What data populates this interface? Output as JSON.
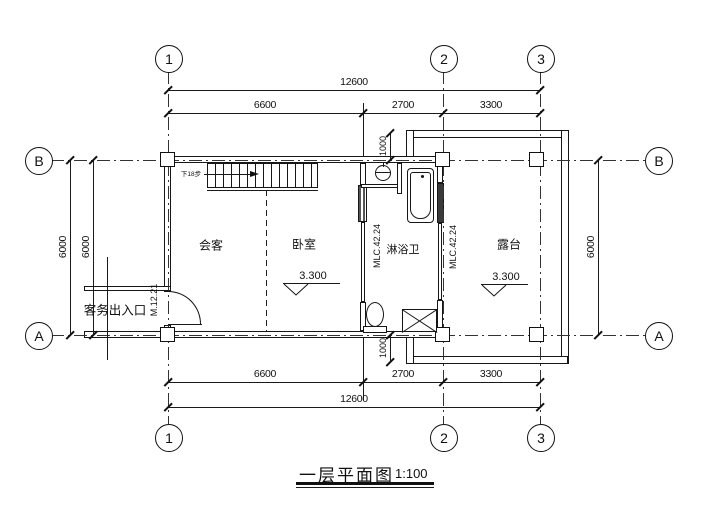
{
  "title": {
    "text": "一层平面图",
    "scale": "1:100"
  },
  "grid": {
    "v": [
      "1",
      "2",
      "3"
    ],
    "h": [
      "B",
      "A"
    ]
  },
  "dims": {
    "top": {
      "overall": "12600",
      "s1": "6600",
      "s2": "2700",
      "s3": "3300"
    },
    "bottom": {
      "overall": "12600",
      "s1": "6600",
      "s2": "2700",
      "s3": "3300"
    },
    "left": {
      "outer": "6000",
      "inner": "6000"
    },
    "right": {
      "depth": "6000"
    },
    "offsets": {
      "top": "1000",
      "bottom": "1000"
    }
  },
  "rooms": {
    "reception": "会客",
    "bedroom": "卧室",
    "bath": "淋浴卫",
    "terrace": "露台"
  },
  "levels": {
    "bedroom": "3.300",
    "terrace": "3.300"
  },
  "annot": {
    "entrance": "客务出入口",
    "door": "M.12.21",
    "mlc_left": "MLC.42.24",
    "mlc_right": "MLC.42.24",
    "stair": "下18步"
  }
}
